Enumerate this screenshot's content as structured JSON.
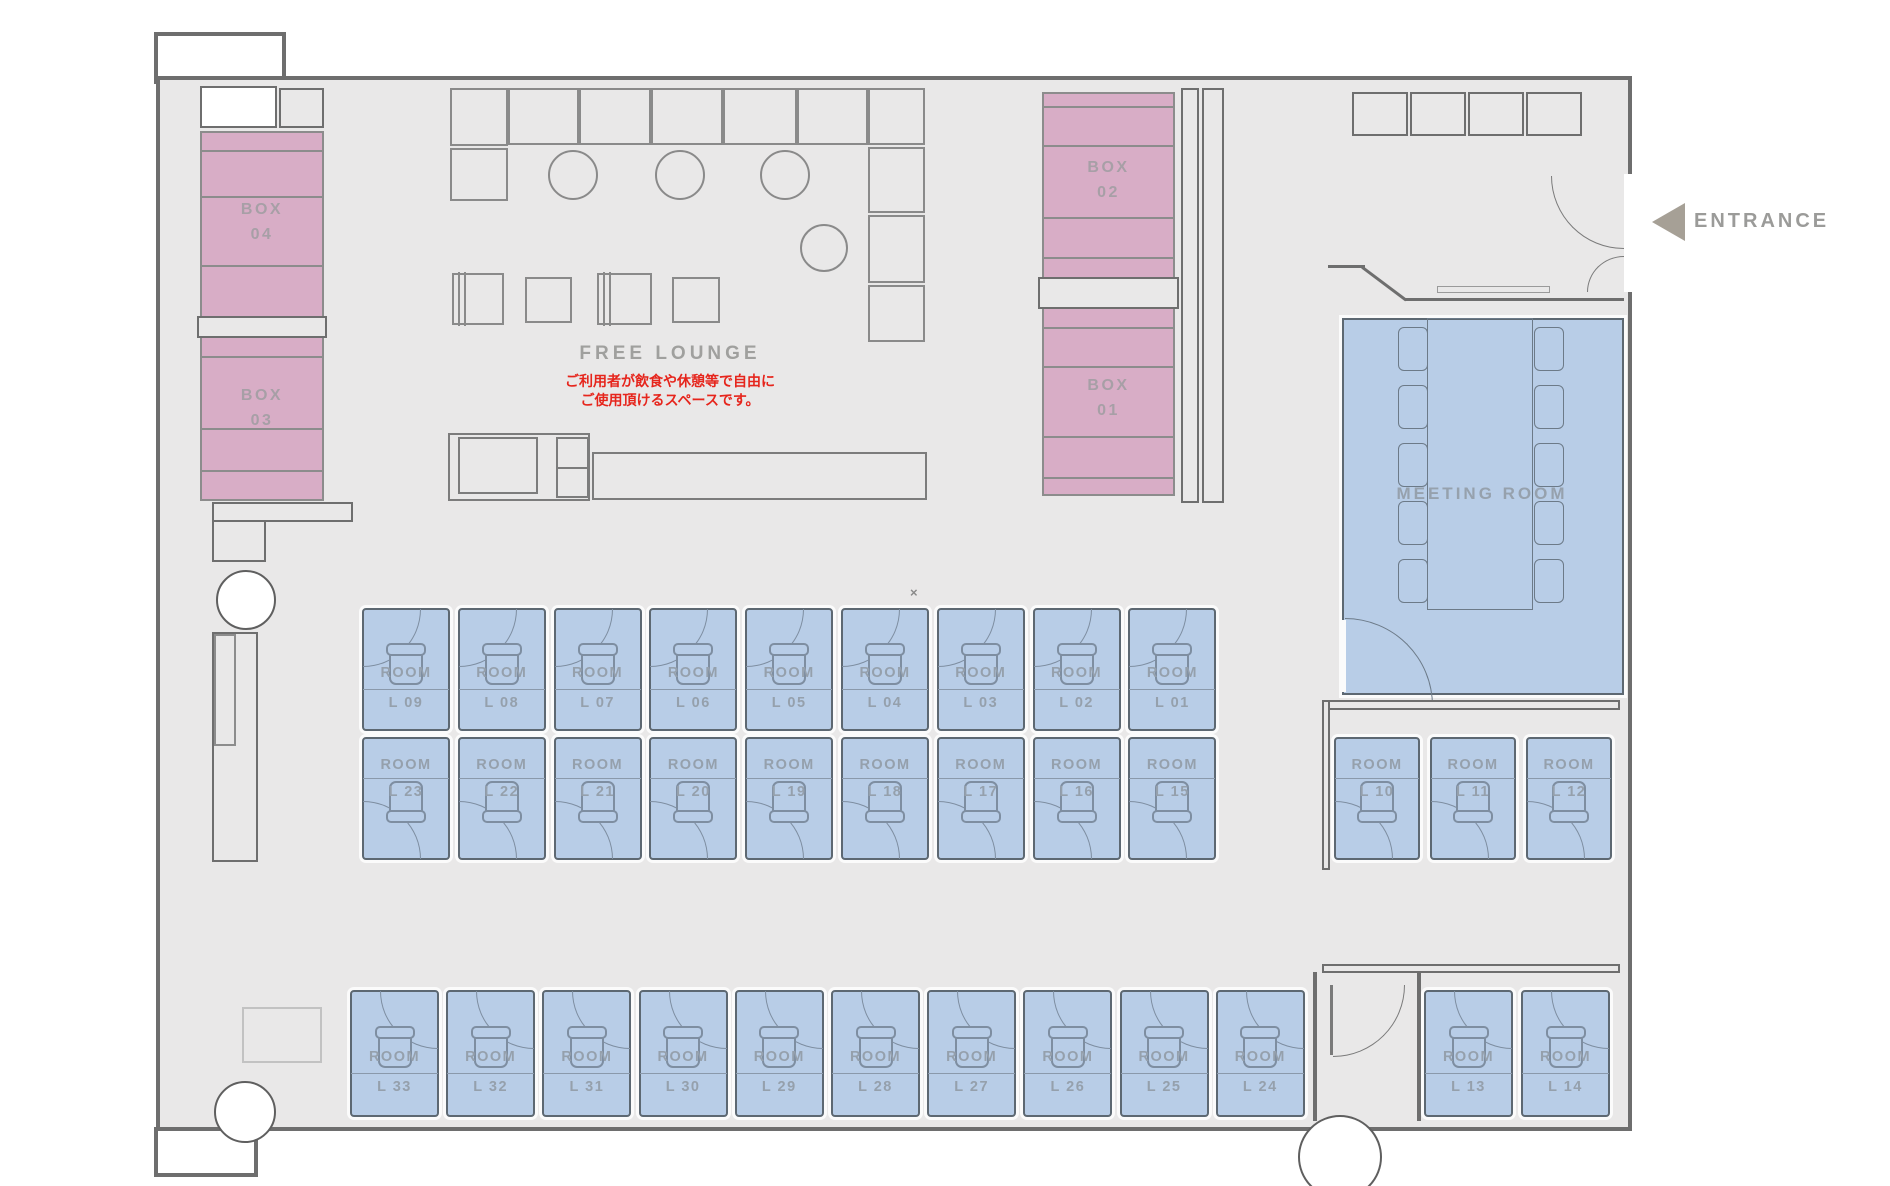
{
  "plan": {
    "entrance_label": "ENTRANCE",
    "free_lounge": {
      "title": "FREE LOUNGE",
      "note1": "ご利用者が飲食や休憩等で自由に",
      "note2": "ご使用頂けるスペースです。"
    },
    "meeting_room_label": "MEETING ROOM",
    "x_mark": "×",
    "boxes": {
      "box04": {
        "name": "BOX",
        "num": "04"
      },
      "box03": {
        "name": "BOX",
        "num": "03"
      },
      "box02": {
        "name": "BOX",
        "num": "02"
      },
      "box01": {
        "name": "BOX",
        "num": "01"
      }
    },
    "rooms": {
      "word": "ROOM",
      "row_top": [
        "L 09",
        "L 08",
        "L 07",
        "L 06",
        "L 05",
        "L 04",
        "L 03",
        "L 02",
        "L 01"
      ],
      "row_middle": [
        "L 23",
        "L 22",
        "L 21",
        "L 20",
        "L 19",
        "L 18",
        "L 17",
        "L 16",
        "L 15"
      ],
      "row_right": [
        "L 10",
        "L 11",
        "L 12"
      ],
      "row_bottom": [
        "L 33",
        "L 32",
        "L 31",
        "L 30",
        "L 29",
        "L 28",
        "L 27",
        "L 26",
        "L 25",
        "L 24"
      ],
      "row_bottom_right": [
        "L 13",
        "L 14"
      ]
    },
    "colors": {
      "room_fill": "#b8cde7",
      "box_fill": "#d8adc6",
      "floor": "#e9e8e8",
      "wall": "#6e6e6e",
      "accent_red": "#e6251c"
    }
  }
}
